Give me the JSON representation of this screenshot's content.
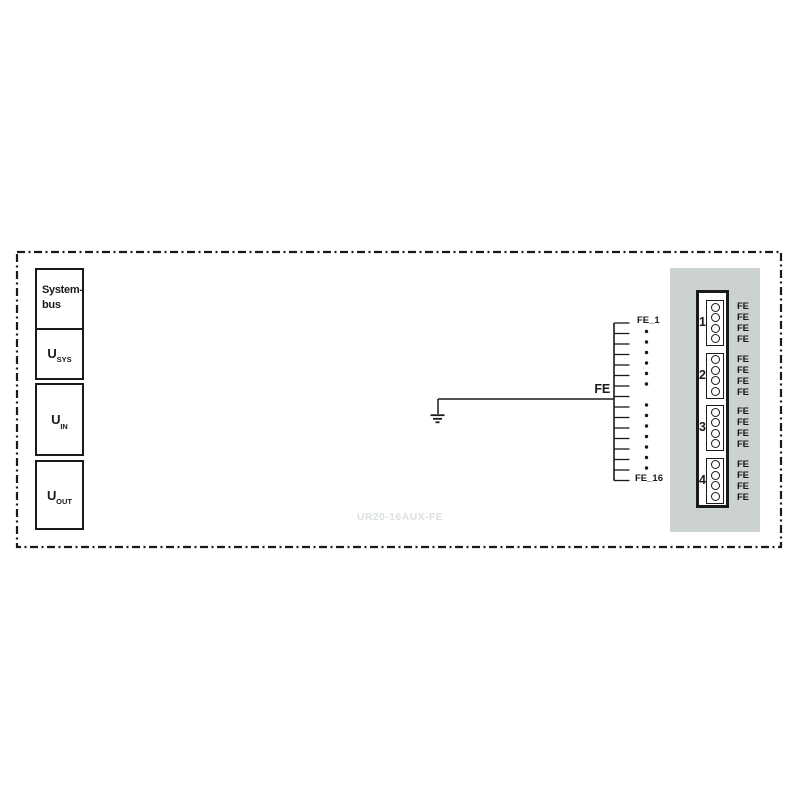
{
  "diagram": {
    "module_name": "UR20-16AUX-FE",
    "colors": {
      "line": "#1a1a1a",
      "panel_bg": "#ccd2d0",
      "watermark_text": "#dbe1df"
    },
    "left_stack": {
      "systembus_label": "System-bus",
      "usys": {
        "base": "U",
        "sub": "SYS"
      },
      "uin": {
        "base": "U",
        "sub": "IN"
      },
      "uout": {
        "base": "U",
        "sub": "OUT"
      }
    },
    "ground_bus": {
      "junction_label": "FE",
      "first_pin_label": "FE_1",
      "last_pin_label": "FE_16",
      "tick_count": 16,
      "dot_rows": [
        1,
        2,
        3,
        4,
        5,
        6,
        8,
        9,
        10,
        11,
        12,
        13,
        14
      ]
    },
    "connector": {
      "groups": [
        {
          "number": "1",
          "pins": [
            "FE",
            "FE",
            "FE",
            "FE"
          ]
        },
        {
          "number": "2",
          "pins": [
            "FE",
            "FE",
            "FE",
            "FE"
          ]
        },
        {
          "number": "3",
          "pins": [
            "FE",
            "FE",
            "FE",
            "FE"
          ]
        },
        {
          "number": "4",
          "pins": [
            "FE",
            "FE",
            "FE",
            "FE"
          ]
        }
      ]
    }
  }
}
